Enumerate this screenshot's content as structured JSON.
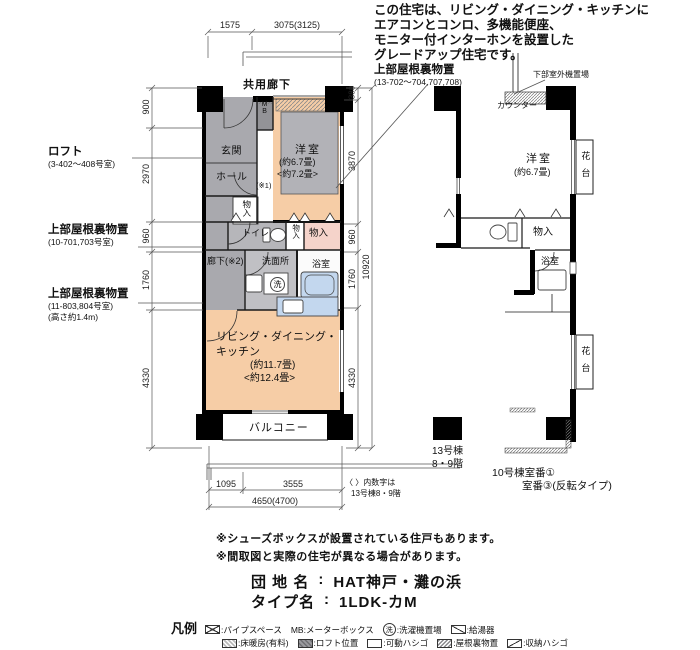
{
  "intro": {
    "lines": [
      "この住宅は、リビング・ダイニング・キッチンに",
      "エアコンとコンロ、多機能便座、",
      "モニター付インターホンを設置した",
      "グレードアップ住宅です。"
    ]
  },
  "callouts": {
    "attic_top_title": "上部屋根裏物置",
    "attic_top_sub": "(13-702〜704,707,708)",
    "loft_title": "ロフト",
    "loft_sub": "(3-402〜408号室)",
    "attic_mid_title": "上部屋根裏物置",
    "attic_mid_sub": "(10-701,703号室)",
    "attic_low_title": "上部屋根裏物置",
    "attic_low_sub": "(11-803,804号室)",
    "attic_low_sub2": "(高さ約1.4m)",
    "outdoor_unit": "下部室外機置場",
    "counter": "カウンター"
  },
  "main_plan": {
    "common_corridor": "共用廊下",
    "balcony": "バルコニー",
    "entrance": "玄関",
    "hall": "ホール",
    "meter_box": "MB",
    "western_room": "洋室",
    "western_room_size1": "(約6.7畳)",
    "western_room_size2": "<約7.2畳>",
    "toilet": "トイレ",
    "storage_hall": "物入",
    "storage_mid": "物入",
    "storage_right": "物入",
    "corridor": "廊下(※2)",
    "washroom": "洗面所",
    "bathroom": "浴室",
    "washer_glyph": "洗",
    "note_ref": "(※1)",
    "ldk_line1": "リビング・ダイニング・",
    "ldk_line2": "キッチン",
    "ldk_size1": "(約11.7畳)",
    "ldk_size2": "<約12.4畳>"
  },
  "dims": {
    "top": [
      "1575",
      "3075(3125)"
    ],
    "left": [
      "900",
      "2970",
      "960",
      "1760",
      "4330"
    ],
    "right": [
      "380",
      "3870",
      "960",
      "1760",
      "4330"
    ],
    "right_total": "10920",
    "bottom": [
      "1095",
      "3555"
    ],
    "bottom_total": "4650(4700)",
    "bracket_note1": "〈 〉内数字は",
    "bracket_note2": "13号棟8・9階"
  },
  "sub_plan": {
    "western_room": "洋室",
    "western_room_size": "(約6.7畳)",
    "storage": "物入",
    "bathroom": "浴室",
    "flower_stand1": "花台",
    "flower_stand2": "花台",
    "bldg13_line1": "13号棟",
    "bldg13_line2": "8・9階",
    "bldg10_line1": "10号棟室番①",
    "bldg10_line2": "室番③(反転タイプ)"
  },
  "notes": [
    "※シューズボックスが設置されている住戸もあります。",
    "※間取図と実際の住宅が異なる場合があります。"
  ],
  "title_block": {
    "estate_label": "団 地 名",
    "separator": ":",
    "estate_value": "HAT神戸・灘の浜",
    "type_label": "タイプ名",
    "type_value": "1LDK-カM"
  },
  "legend": {
    "heading": "凡例",
    "washer_glyph": "洗",
    "pipe_space": ":パイプスペース",
    "mb_item": "MB:メーターボックス",
    "washer": ":洗濯機置場",
    "water_heater": ":給湯器",
    "floor_heating": ":床暖房(有料)",
    "loft_position": ":ロフト位置",
    "movable_ladder": ":可動ハシゴ",
    "attic_storage": ":屋根裏物置",
    "storage_ladder": ":収納ハシゴ"
  },
  "colors": {
    "room_peach": "#f6cda6",
    "room_gray": "#a9a9ae",
    "room_pink": "#f5d3ca",
    "fixture_blue": "#c3d7ee",
    "wall_black": "#000000"
  }
}
